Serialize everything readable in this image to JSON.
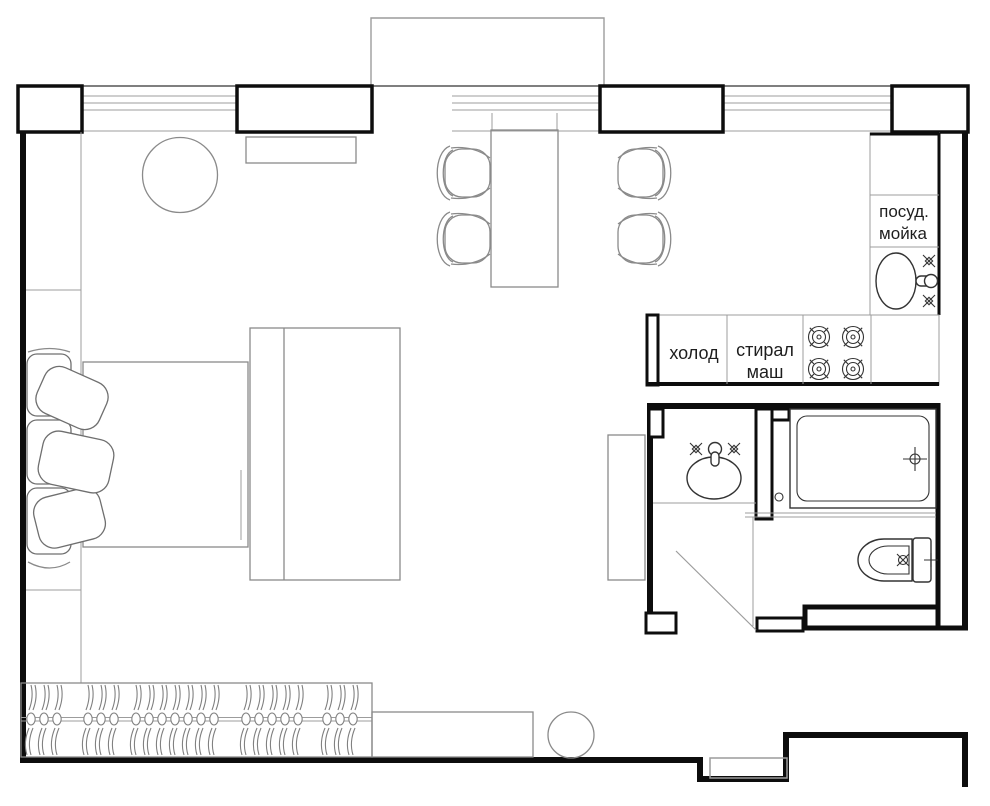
{
  "labels": {
    "dishwasher_sink_line1": "посуд.",
    "dishwasher_sink_line2": "мойка",
    "fridge": "холод",
    "washing_machine_line1": "стирал",
    "washing_machine_line2": "маш"
  },
  "wardrobe": {
    "hanger_groups": [
      3,
      3,
      7,
      5,
      3
    ]
  },
  "colors": {
    "wall": "#0d0d0d",
    "furniture_line": "#8a8a8a",
    "fixture_line": "#333333",
    "label_text": "#1e1e1e",
    "background": "#ffffff"
  }
}
